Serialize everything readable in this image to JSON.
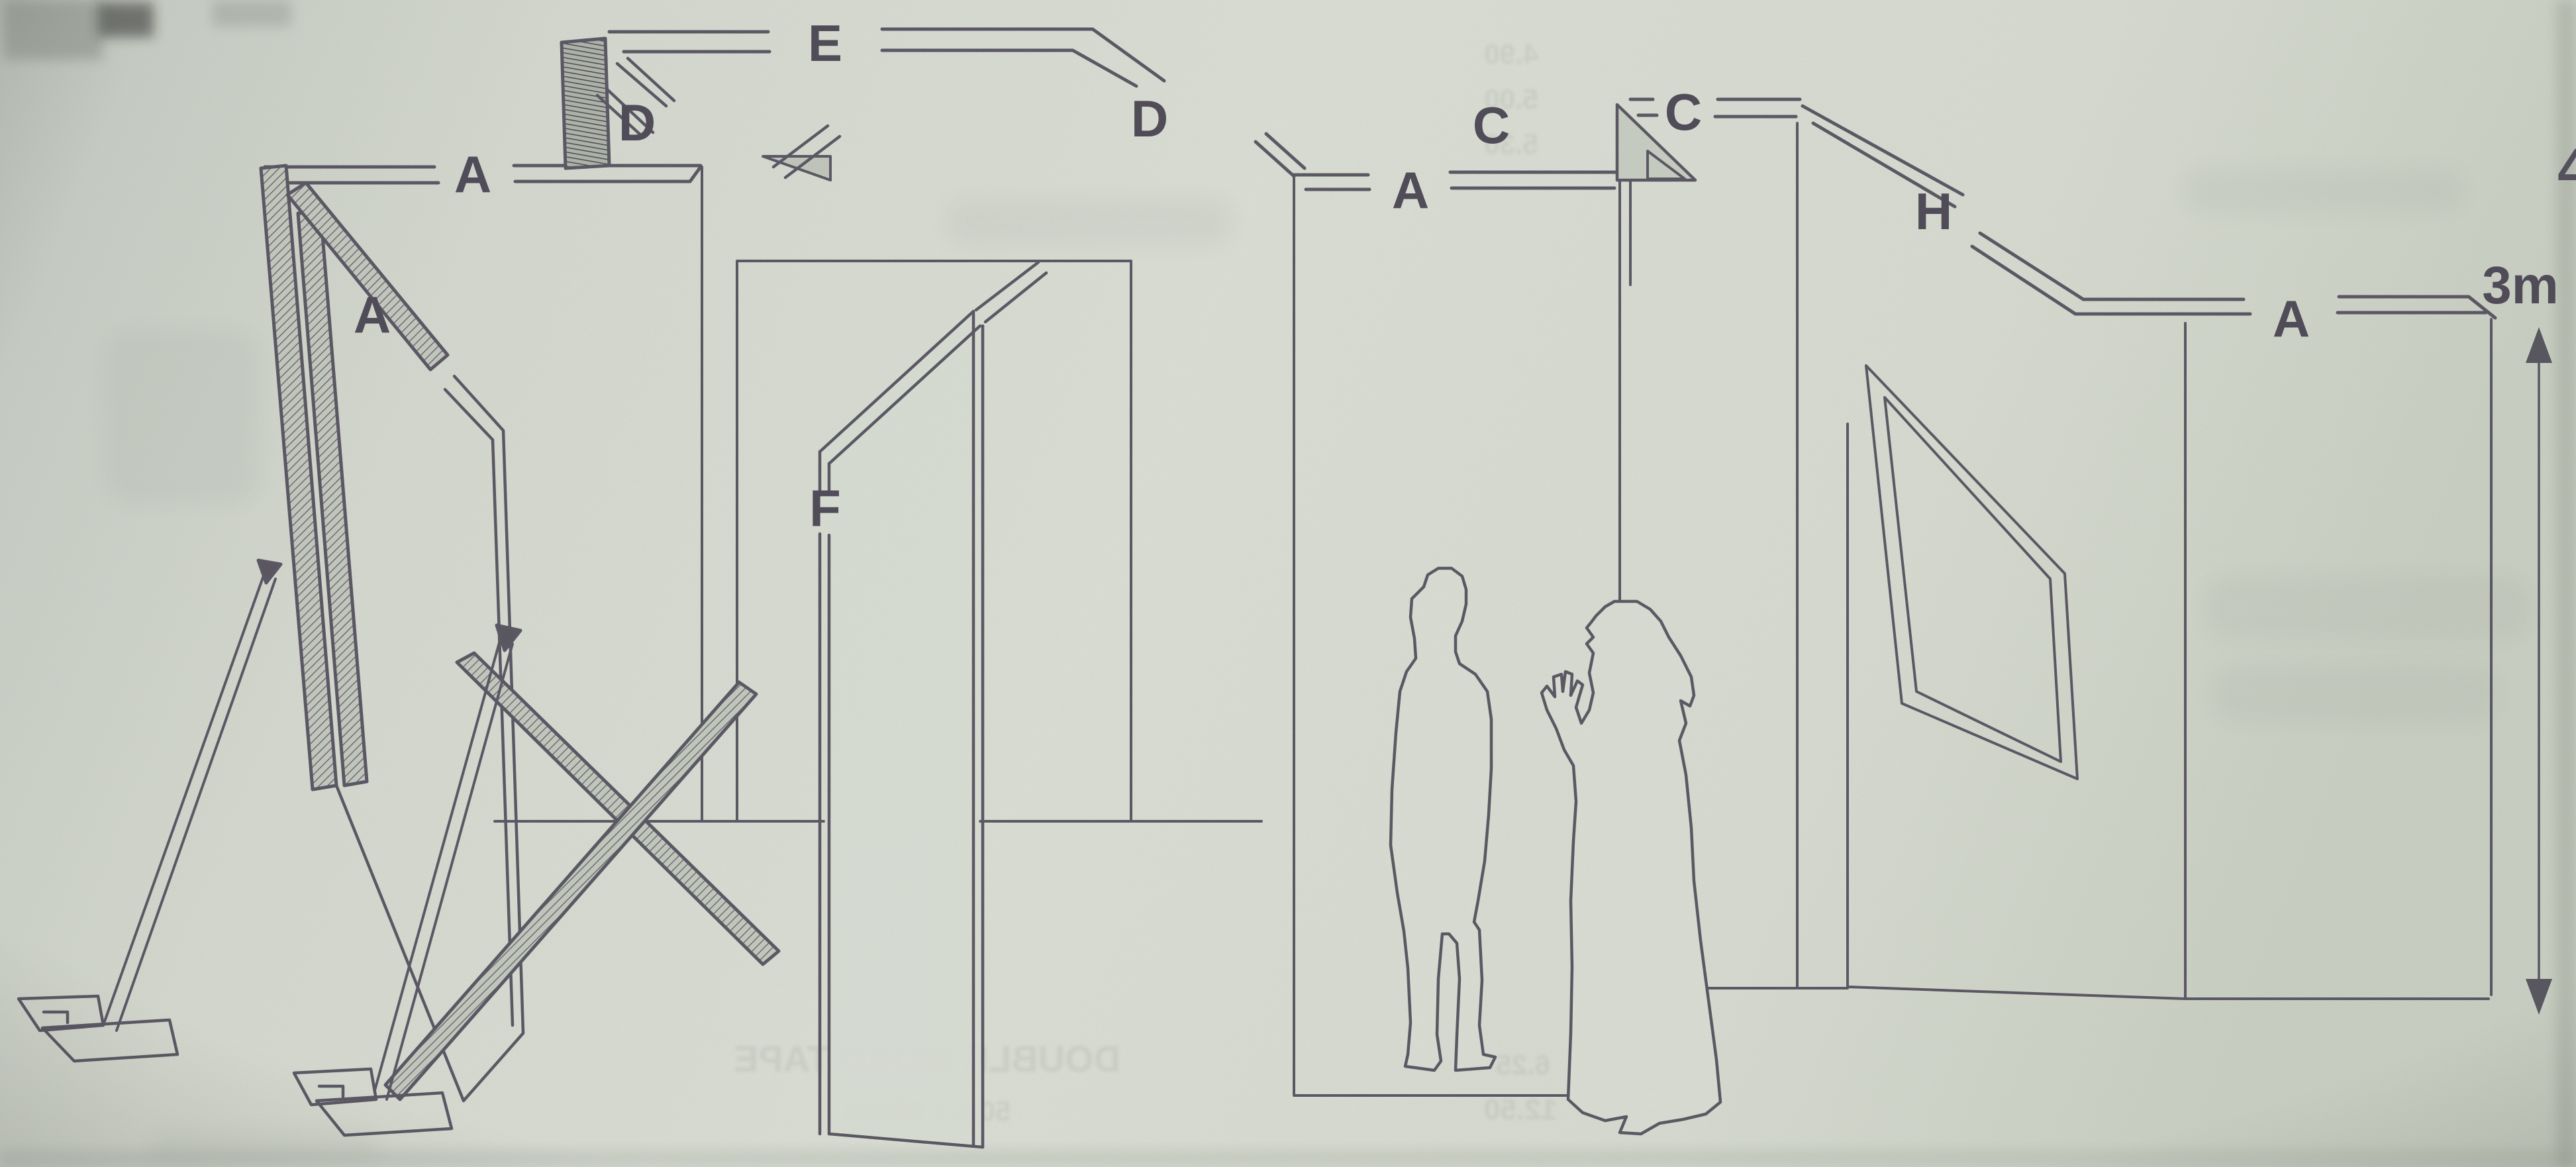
{
  "diagram": {
    "kind": "scanned exploded line diagram of a modular display wall system with two human figures for scale",
    "part_labels": [
      {
        "id": "a-wall1-top-rail",
        "text": "A"
      },
      {
        "id": "a-easel-sloped-rail",
        "text": "A"
      },
      {
        "id": "d-corner-post",
        "text": "D"
      },
      {
        "id": "e-top-rail",
        "text": "E"
      },
      {
        "id": "d-step-rail",
        "text": "D"
      },
      {
        "id": "a-mid-wall-rail",
        "text": "A"
      },
      {
        "id": "c-corner-left",
        "text": "C"
      },
      {
        "id": "c-rail-right",
        "text": "C"
      },
      {
        "id": "f-door-panel",
        "text": "F"
      },
      {
        "id": "h-sloped-rail",
        "text": "H"
      },
      {
        "id": "a-right-wall-rail",
        "text": "A"
      }
    ],
    "dimension_label": "3m",
    "page_number_partial": "4",
    "bleed_through_fragments": [
      {
        "text": "DOUBLE SIDED TAPE"
      },
      {
        "text": "50m x 50mm"
      },
      {
        "text": "12.50"
      },
      {
        "text": "6.25"
      },
      {
        "text": "4.90"
      },
      {
        "text": "5.00"
      },
      {
        "text": "5.30"
      }
    ]
  }
}
